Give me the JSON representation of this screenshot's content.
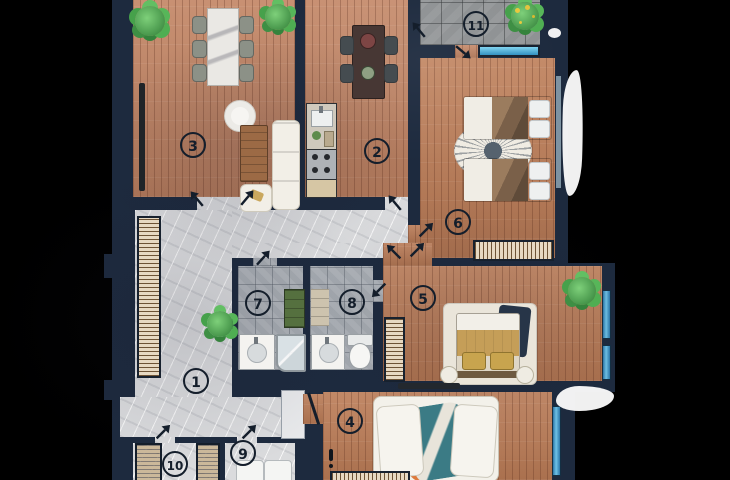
{
  "rooms": [
    {
      "number": "1"
    },
    {
      "number": "2"
    },
    {
      "number": "3"
    },
    {
      "number": "4"
    },
    {
      "number": "5"
    },
    {
      "number": "6"
    },
    {
      "number": "7"
    },
    {
      "number": "8"
    },
    {
      "number": "9"
    },
    {
      "number": "10"
    },
    {
      "number": "11"
    }
  ],
  "colors": {
    "background": "#000000",
    "wall": "#1d2a3e",
    "wood_floor": "#c28463",
    "marble_floor": "#dadbdd",
    "bathroom_tile": "#a6abb1",
    "balcony_tile": "#8e9193",
    "window_blue": "#49a8d8",
    "plant_green": "#3f9b43",
    "badge_outline": "#141e2b"
  }
}
